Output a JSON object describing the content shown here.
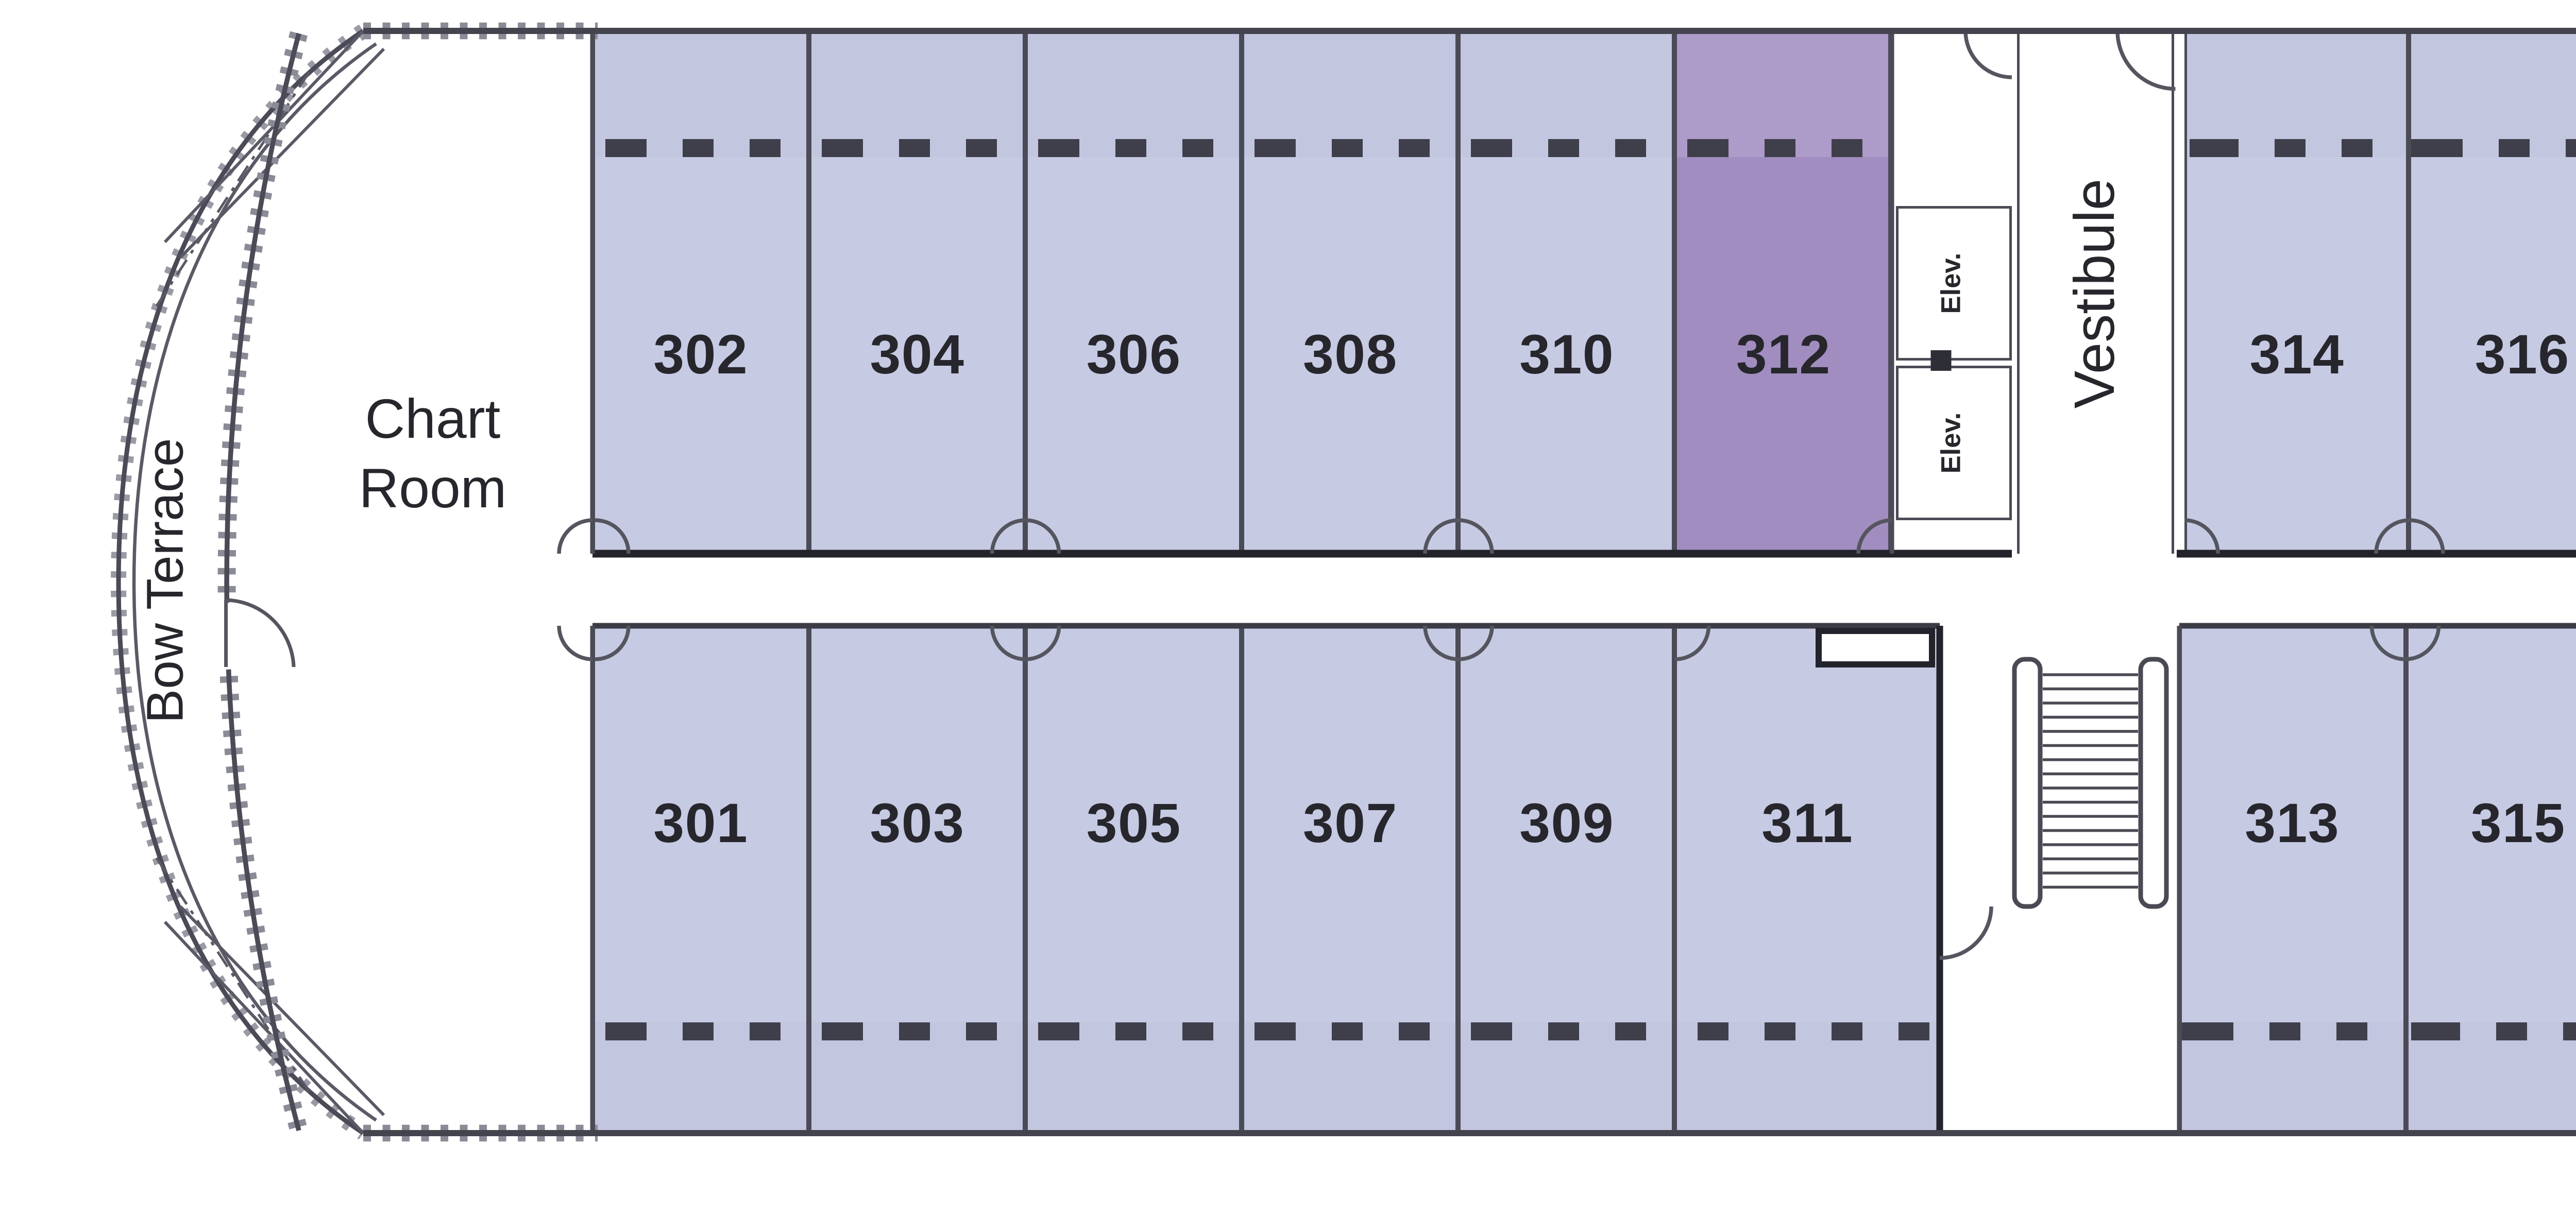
{
  "deck": {
    "labels": {
      "bow_terrace": "Bow Terrace",
      "chart_room_line1": "Chart",
      "chart_room_line2": "Room",
      "vestibule": "Vestibule",
      "elevator_top": "Elev.",
      "elevator_bottom": "Elev."
    },
    "cabins_top": [
      {
        "number": "302",
        "highlighted": false
      },
      {
        "number": "304",
        "highlighted": false
      },
      {
        "number": "306",
        "highlighted": false
      },
      {
        "number": "308",
        "highlighted": false
      },
      {
        "number": "310",
        "highlighted": false
      },
      {
        "number": "312",
        "highlighted": true
      },
      {
        "number": "314",
        "highlighted": false
      },
      {
        "number": "316",
        "highlighted": false
      },
      {
        "number": "318",
        "highlighted": false
      },
      {
        "number": "320",
        "highlighted": false
      },
      {
        "number": "322",
        "highlighted": false
      },
      {
        "number": "324",
        "highlighted": false
      },
      {
        "number": "326",
        "highlighted": false
      }
    ],
    "cabins_bottom": [
      {
        "number": "301",
        "highlighted": false
      },
      {
        "number": "303",
        "highlighted": false
      },
      {
        "number": "305",
        "highlighted": false
      },
      {
        "number": "307",
        "highlighted": false
      },
      {
        "number": "309",
        "highlighted": false
      },
      {
        "number": "311",
        "highlighted": false
      },
      {
        "number": "313",
        "highlighted": false
      },
      {
        "number": "315",
        "highlighted": false
      },
      {
        "number": "317",
        "highlighted": false
      },
      {
        "number": "319",
        "highlighted": false
      },
      {
        "number": "321",
        "highlighted": false
      },
      {
        "number": "323",
        "highlighted": true
      },
      {
        "number": "325",
        "highlighted": false
      }
    ],
    "highlighted_cabins": [
      "312",
      "323"
    ],
    "colors": {
      "cabin_fill": "#c6cae3",
      "cabin_strip": "#c2c6df",
      "highlight_fill": "#a18dc0",
      "highlight_strip": "#ad9bca",
      "wall": "#4b4b57",
      "corridor_wall": "#23232b",
      "window_dash": "#3f3f4b",
      "text": "#26262c"
    }
  }
}
